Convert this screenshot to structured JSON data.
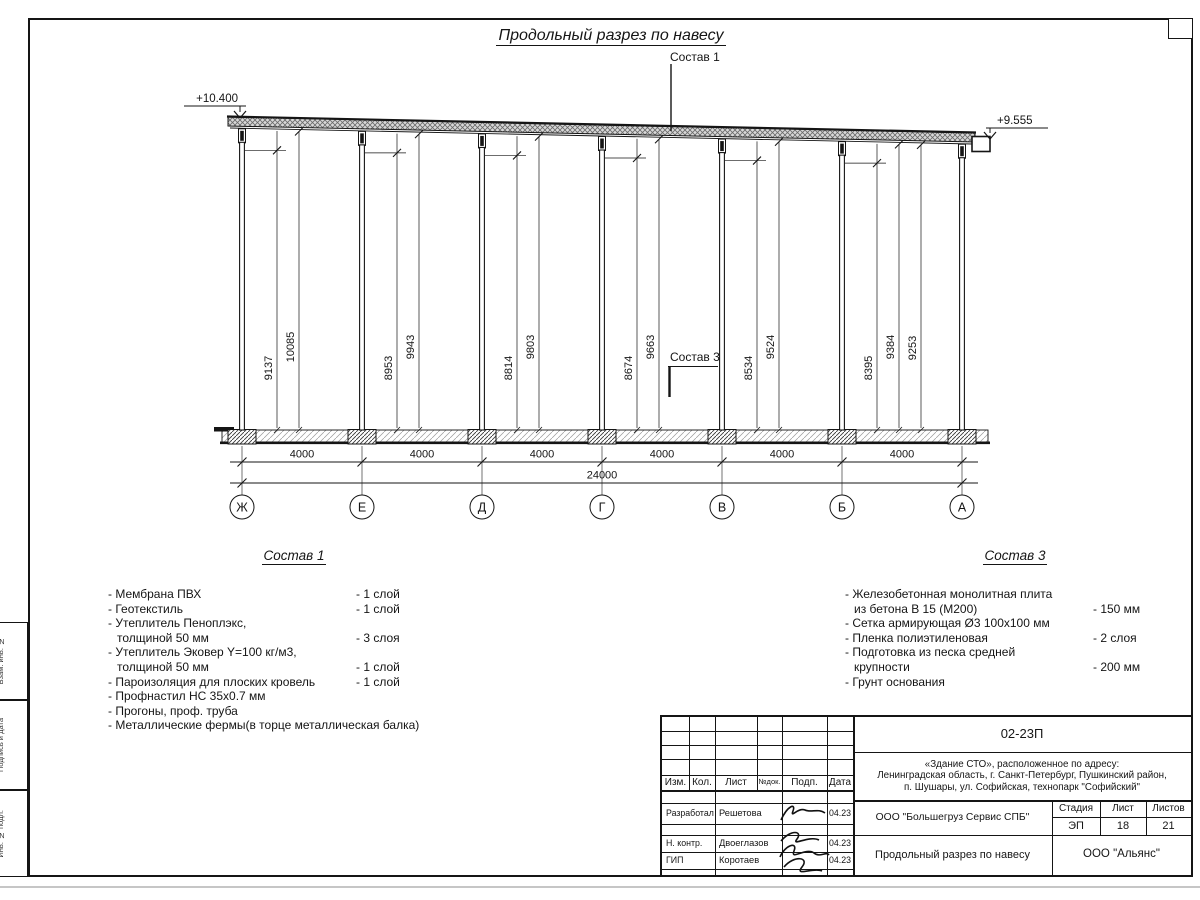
{
  "sheet": {
    "title": "Продольный разрез по навесу"
  },
  "drawing": {
    "callout_top": "Состав 1",
    "callout_mid": "Состав 3",
    "elevation_left": "+10.400",
    "elevation_right": "+9.555",
    "axes": [
      "Ж",
      "Е",
      "Д",
      "Г",
      "В",
      "Б",
      "А"
    ],
    "bay_dims": [
      "4000",
      "4000",
      "4000",
      "4000",
      "4000",
      "4000"
    ],
    "total_dim": "24000",
    "height_dims": [
      [
        "9137",
        "10085"
      ],
      [
        "8953",
        "9943"
      ],
      [
        "8814",
        "9803"
      ],
      [
        "8674",
        "9663"
      ],
      [
        "8534",
        "9524"
      ],
      [
        "8395",
        "9384",
        "9253"
      ]
    ]
  },
  "sostav1": {
    "heading": "Состав 1",
    "items": [
      {
        "name": "- Мембрана ПВХ",
        "qty": "- 1 слой",
        "indent": false
      },
      {
        "name": "- Геотекстиль",
        "qty": "- 1 слой",
        "indent": false
      },
      {
        "name": "- Утеплитель Пеноплэкс,",
        "qty": "",
        "indent": false
      },
      {
        "name": "толщиной 50 мм",
        "qty": "- 3 слоя",
        "indent": true
      },
      {
        "name": "- Утеплитель Эковер Y=100 кг/м3,",
        "qty": "",
        "indent": false
      },
      {
        "name": "толщиной 50 мм",
        "qty": "- 1 слой",
        "indent": true
      },
      {
        "name": "- Пароизоляция для плоских кровель",
        "qty": "- 1 слой",
        "indent": false
      },
      {
        "name": "- Профнастил НС 35х0.7 мм",
        "qty": "",
        "indent": false
      },
      {
        "name": "- Прогоны, проф. труба",
        "qty": "",
        "indent": false
      },
      {
        "name": "- Металлические фермы(в торце металлическая балка)",
        "qty": "",
        "indent": false
      }
    ]
  },
  "sostav3": {
    "heading": "Состав 3",
    "items": [
      {
        "name": "- Железобетонная  монолитная плита",
        "qty": "",
        "indent": false
      },
      {
        "name": "из бетона В 15 (М200)",
        "qty": "- 150 мм",
        "indent": true
      },
      {
        "name": "- Сетка армирующая Ø3 100х100 мм",
        "qty": "",
        "indent": false
      },
      {
        "name": "- Пленка полиэтиленовая",
        "qty": "-  2 слоя",
        "indent": false
      },
      {
        "name": "- Подготовка из песка средней",
        "qty": "",
        "indent": false
      },
      {
        "name": "крупности",
        "qty": "- 200 мм",
        "indent": true
      },
      {
        "name": "- Грунт основания",
        "qty": "",
        "indent": false
      }
    ]
  },
  "titleblock": {
    "doc_number": "02-23П",
    "project_line1": "«Здание СТО», расположенное по адресу:",
    "project_line2": "Ленинградская область, г. Санкт-Петербург, Пушкинский район,",
    "project_line3": "п. Шушары, ул. Софийская, технопарк \"Софийский\"",
    "cols": {
      "izm": "Изм.",
      "kol": "Кол.",
      "list": "Лист",
      "ndok": "№док.",
      "podp": "Подп.",
      "data": "Дата"
    },
    "rows": [
      {
        "role": "Разработал",
        "name": "Решетова",
        "date": "04.23"
      },
      {
        "role": "Н. контр.",
        "name": "Двоеглазов",
        "date": "04.23"
      },
      {
        "role": "ГИП",
        "name": "Коротаев",
        "date": "04.23"
      }
    ],
    "company": "ООО \"Большегруз Сервис СПБ\"",
    "stage_label": "Стадия",
    "list_label": "Лист",
    "listov_label": "Листов",
    "stage_value": "ЭП",
    "list_value": "18",
    "listov_value": "21",
    "drawing_title": "Продольный разрез по навесу",
    "org": "ООО \"Альянс\""
  },
  "frame": {
    "side_labels": [
      "Взам. инв. №",
      "Подпись и дата",
      "Инв. № подл."
    ]
  }
}
